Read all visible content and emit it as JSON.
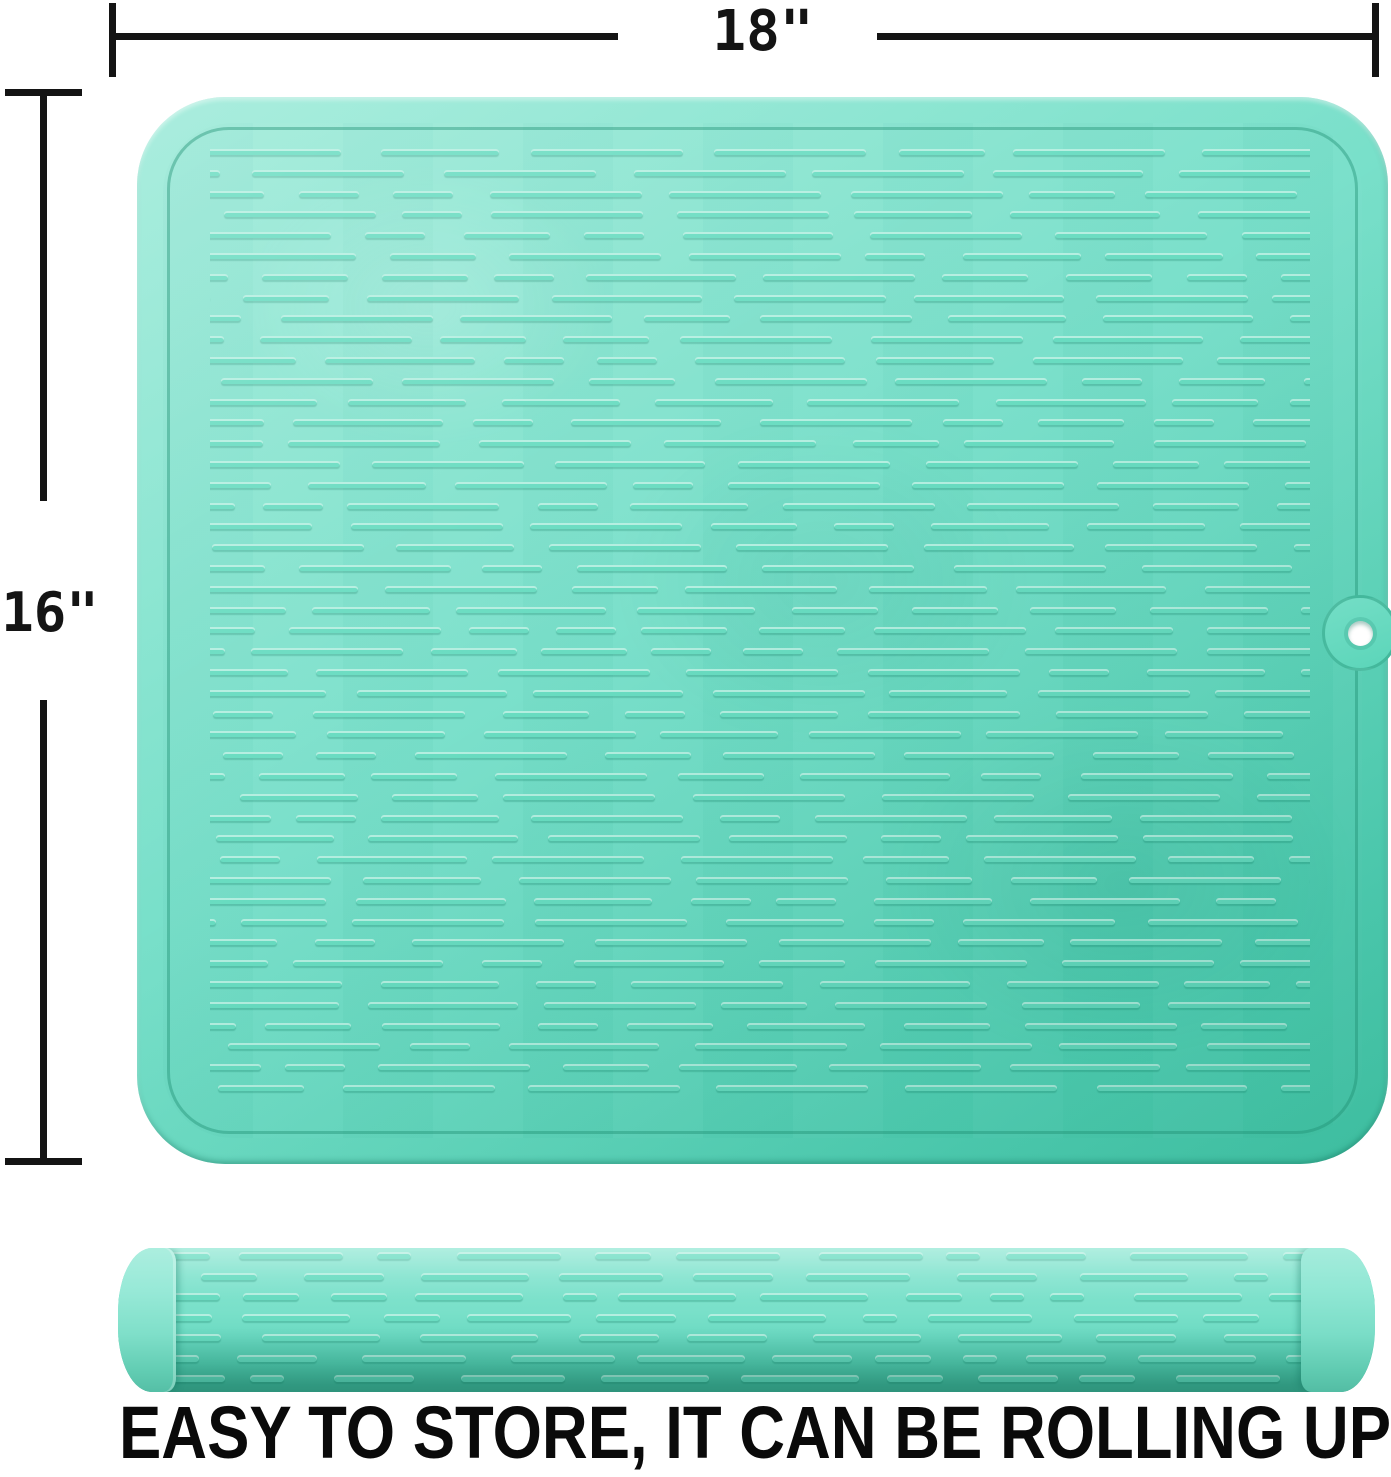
{
  "dimensions": {
    "width_label": "18\"",
    "height_label": "16\""
  },
  "caption": "EASY TO STORE, IT CAN BE ROLLING UP",
  "colors": {
    "mat-light": "#96E9D6",
    "mat-base": "#7CE1CB",
    "mat-deep": "#4CD0B1",
    "ridge": "#69DCC1",
    "groove": "rgba(31,143,115,0.42)",
    "dimension-line": "#141414",
    "caption-text": "#0A0A0A",
    "hole-fill": "#FFFFFF",
    "background": "#FFFFFF"
  }
}
